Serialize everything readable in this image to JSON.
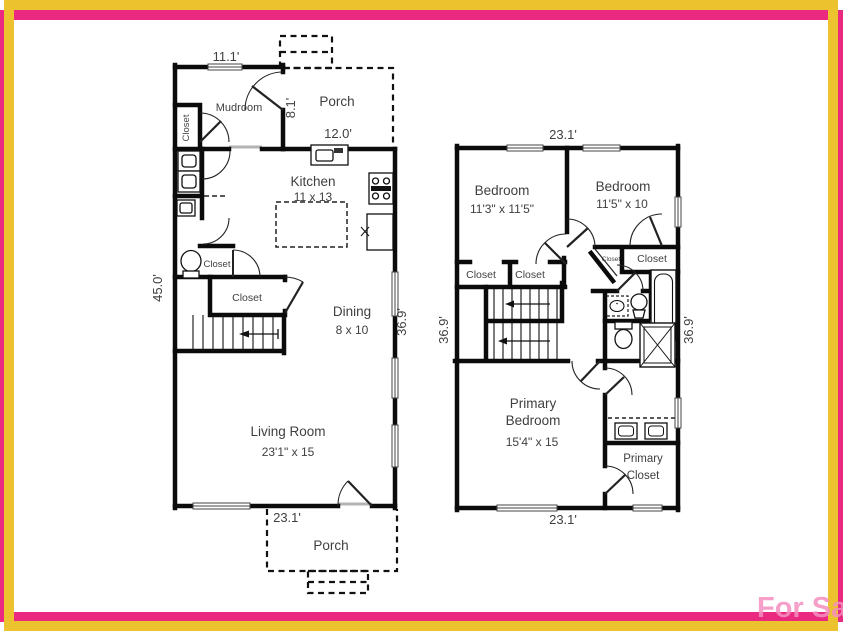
{
  "colors": {
    "border_pink": "#ea2a80",
    "border_yellow": "#ecc32f",
    "wall_black": "#0b0b0b",
    "label_gray": "#3f3f3f"
  },
  "watermark": "For Sa",
  "floor1": {
    "dim_top_mudroom": "11.1'",
    "mudroom": "Mudroom",
    "mudroom_closet": "Closet",
    "porch_top": "Porch",
    "porch_height": "8.1'",
    "porch_width": "12.0'",
    "kitchen_name": "Kitchen",
    "kitchen_size": "11 x 13",
    "dim_left": "45.0'",
    "hall_closet": "Closet",
    "stair_closet": "Closet",
    "dining_name": "Dining",
    "dining_size": "8 x 10",
    "dim_right": "36.9'",
    "living_name": "Living Room",
    "living_size": "23'1\" x 15",
    "dim_bottom": "23.1'",
    "porch_bottom": "Porch"
  },
  "floor2": {
    "dim_top": "23.1'",
    "bedroom1_name": "Bedroom",
    "bedroom1_size": "11'3\" x 11'5\"",
    "bedroom2_name": "Bedroom",
    "bedroom2_size": "11'5\" x 10",
    "closet_left_a": "Closet",
    "closet_left_b": "Closet",
    "closet_tiny": "Closet",
    "closet_bed2": "Closet",
    "dim_left": "36.9'",
    "dim_right": "36.9'",
    "primary_line1": "Primary",
    "primary_line2": "Bedroom",
    "primary_size": "15'4\" x 15",
    "primary_closet_line1": "Primary",
    "primary_closet_line2": "Closet",
    "dim_bottom": "23.1'"
  }
}
